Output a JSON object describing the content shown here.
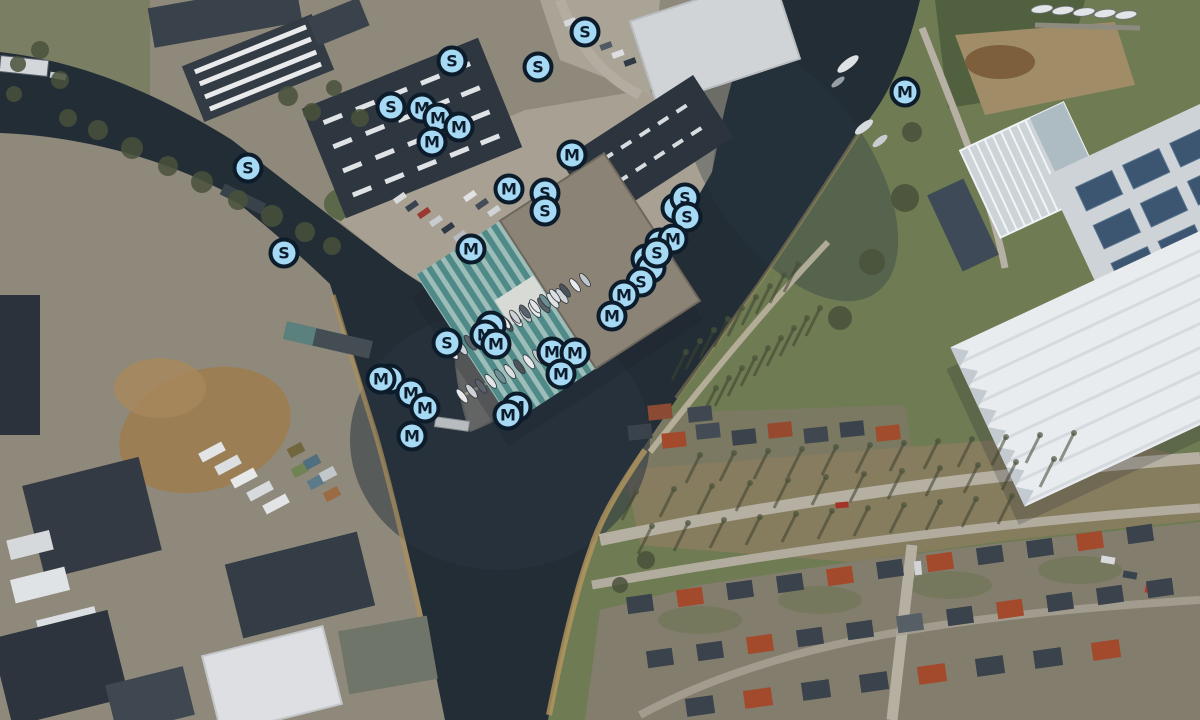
{
  "map": {
    "description": "Aerial photo map of a harbor junction with mooring markers",
    "marker_style": {
      "fill": "#a6d9f4",
      "border": "#0d1c2b",
      "letter_color": "#0d1c2b"
    },
    "markers": [
      {
        "label": "S",
        "x": 585,
        "y": 32
      },
      {
        "label": "S",
        "x": 452,
        "y": 61
      },
      {
        "label": "S",
        "x": 538,
        "y": 67
      },
      {
        "label": "M",
        "x": 905,
        "y": 92
      },
      {
        "label": "S",
        "x": 391,
        "y": 107
      },
      {
        "label": "M",
        "x": 422,
        "y": 108
      },
      {
        "label": "M",
        "x": 438,
        "y": 118
      },
      {
        "label": "M",
        "x": 459,
        "y": 127
      },
      {
        "label": "M",
        "x": 432,
        "y": 142
      },
      {
        "label": "M",
        "x": 572,
        "y": 155
      },
      {
        "label": "S",
        "x": 248,
        "y": 168
      },
      {
        "label": "M",
        "x": 509,
        "y": 189
      },
      {
        "label": "S",
        "x": 545,
        "y": 193
      },
      {
        "label": "",
        "x": 676,
        "y": 208,
        "hidden": true
      },
      {
        "label": "S",
        "x": 685,
        "y": 198
      },
      {
        "label": "S",
        "x": 545,
        "y": 211
      },
      {
        "label": "S",
        "x": 687,
        "y": 217
      },
      {
        "label": "",
        "x": 660,
        "y": 243,
        "hidden": true
      },
      {
        "label": "M",
        "x": 673,
        "y": 239
      },
      {
        "label": "M",
        "x": 471,
        "y": 249
      },
      {
        "label": "S",
        "x": 284,
        "y": 253
      },
      {
        "label": "",
        "x": 646,
        "y": 259,
        "hidden": true
      },
      {
        "label": "",
        "x": 651,
        "y": 268,
        "hidden": true
      },
      {
        "label": "S",
        "x": 657,
        "y": 253
      },
      {
        "label": "S",
        "x": 641,
        "y": 282
      },
      {
        "label": "M",
        "x": 624,
        "y": 295
      },
      {
        "label": "M",
        "x": 612,
        "y": 316
      },
      {
        "label": "",
        "x": 491,
        "y": 326,
        "hidden": true
      },
      {
        "label": "M",
        "x": 485,
        "y": 335
      },
      {
        "label": "S",
        "x": 447,
        "y": 343
      },
      {
        "label": "M",
        "x": 496,
        "y": 344
      },
      {
        "label": "M",
        "x": 552,
        "y": 352
      },
      {
        "label": "M",
        "x": 575,
        "y": 353
      },
      {
        "label": "M",
        "x": 561,
        "y": 374
      },
      {
        "label": "",
        "x": 390,
        "y": 379,
        "hidden": true
      },
      {
        "label": "M",
        "x": 381,
        "y": 379
      },
      {
        "label": "M",
        "x": 411,
        "y": 393
      },
      {
        "label": "M",
        "x": 425,
        "y": 408
      },
      {
        "label": "M",
        "x": 517,
        "y": 407
      },
      {
        "label": "M",
        "x": 508,
        "y": 415
      },
      {
        "label": "M",
        "x": 412,
        "y": 436
      }
    ]
  }
}
